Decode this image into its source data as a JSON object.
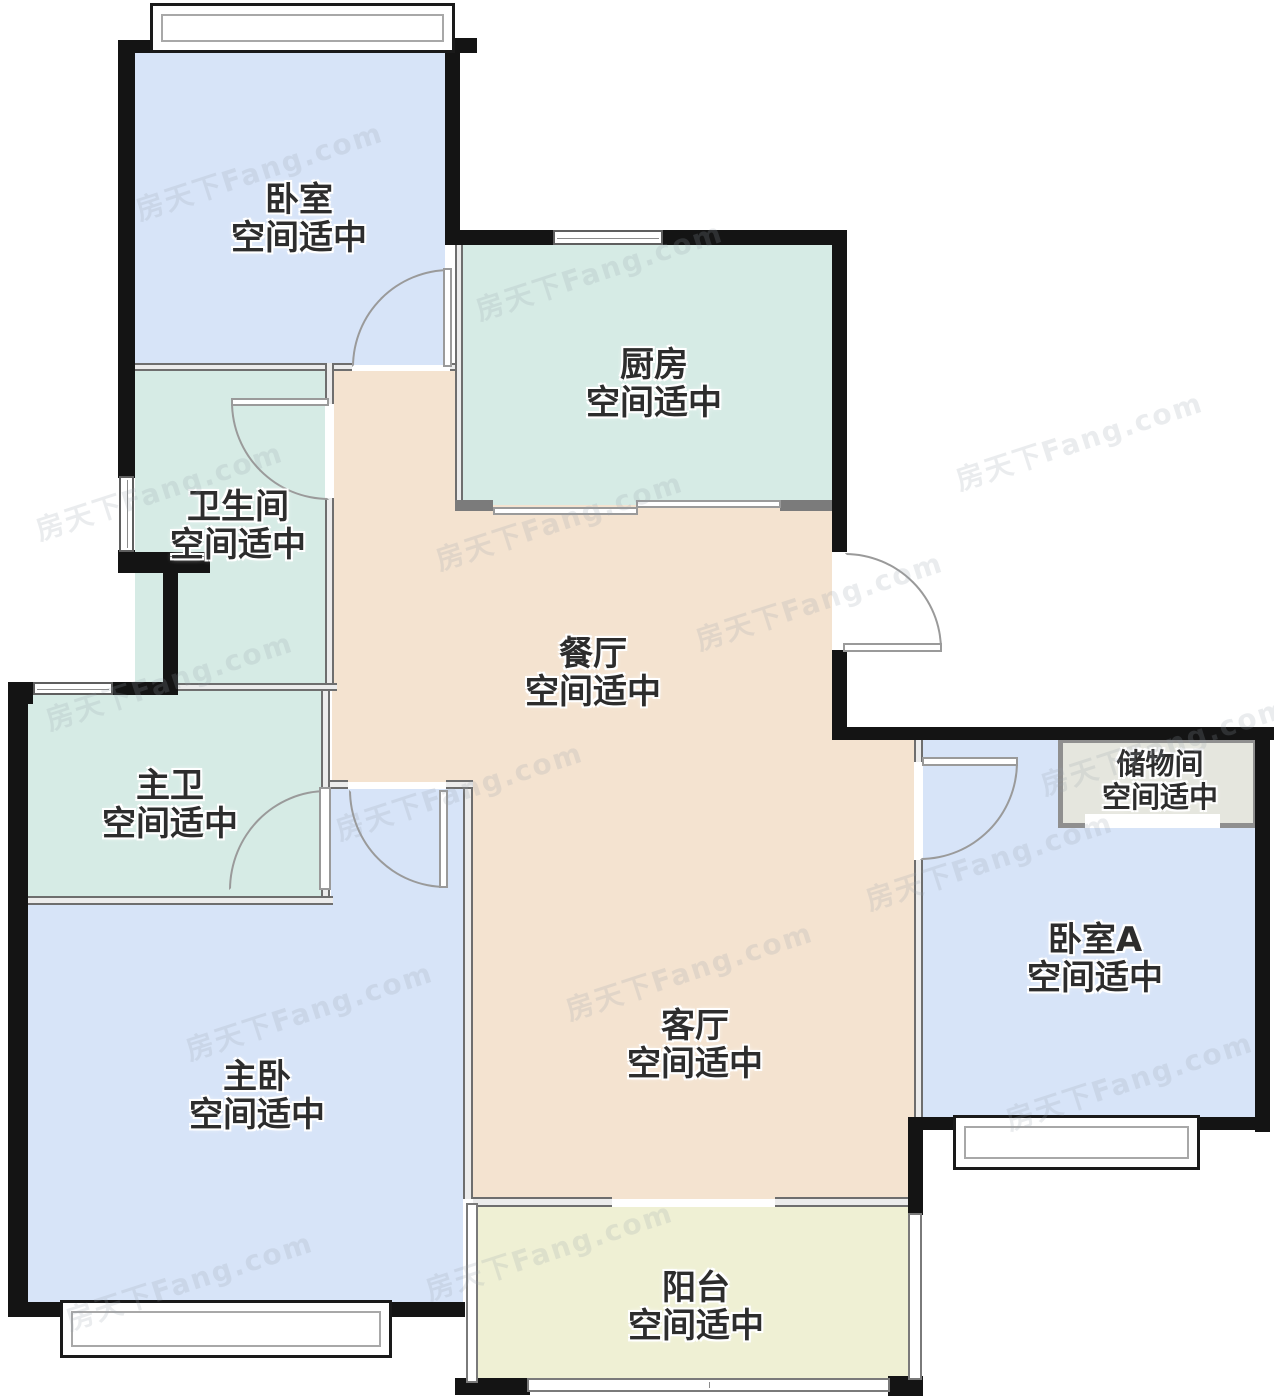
{
  "watermark": {
    "text": "房天下Fang.com"
  },
  "rooms": [
    {
      "id": "bedroom",
      "name": "卧室",
      "condition": "空间适中",
      "color": "#d7e4f8"
    },
    {
      "id": "kitchen",
      "name": "厨房",
      "condition": "空间适中",
      "color": "#d6ebe5"
    },
    {
      "id": "bathroom",
      "name": "卫生间",
      "condition": "空间适中",
      "color": "#d6ebe5"
    },
    {
      "id": "dining-room",
      "name": "餐厅",
      "condition": "空间适中",
      "color": "#f4e3d0"
    },
    {
      "id": "master-bathroom",
      "name": "主卫",
      "condition": "空间适中",
      "color": "#d6ebe5"
    },
    {
      "id": "master-bedroom",
      "name": "主卧",
      "condition": "空间适中",
      "color": "#d7e4f8"
    },
    {
      "id": "living-room",
      "name": "客厅",
      "condition": "空间适中",
      "color": "#f4e3d0"
    },
    {
      "id": "balcony",
      "name": "阳台",
      "condition": "空间适中",
      "color": "#eff0d4"
    },
    {
      "id": "bedroom-a",
      "name": "卧室A",
      "condition": "空间适中",
      "color": "#d7e4f8"
    },
    {
      "id": "storage-room",
      "name": "储物间",
      "condition": "空间适中",
      "color": "#e5e6de"
    }
  ],
  "colors": {
    "wall": "#141414",
    "thin_wall": "#6e6e6e",
    "door_line": "#9a9a9a",
    "label_text": "#2d2d2d",
    "watermark": "#96a2b2",
    "background": "#ffffff"
  }
}
